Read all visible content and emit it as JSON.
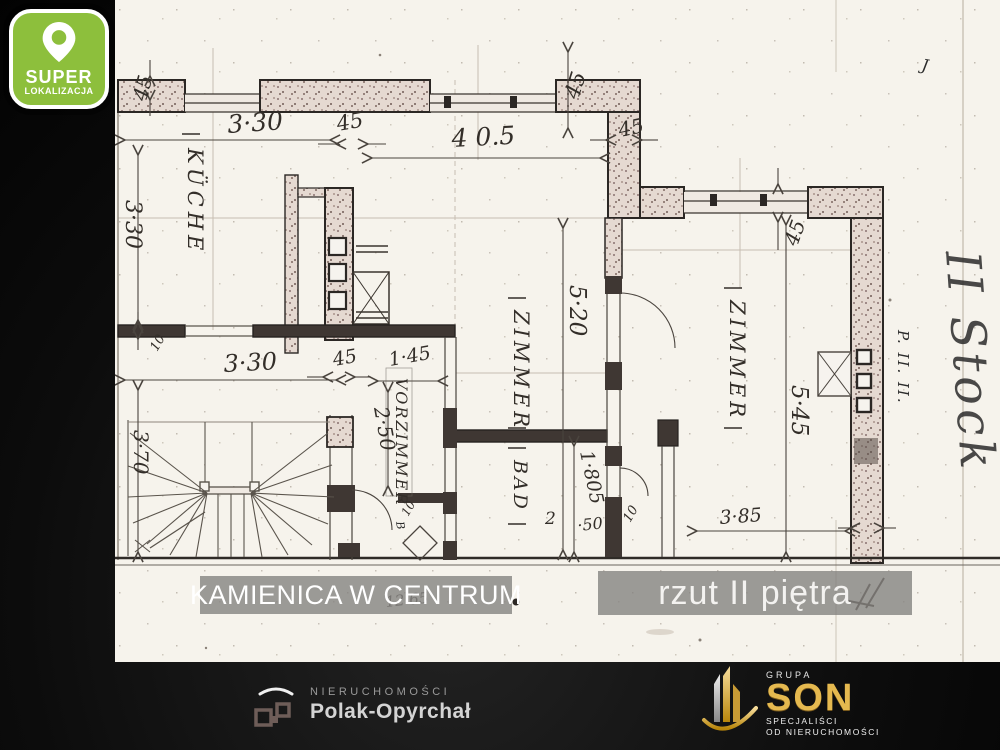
{
  "badge": {
    "title": "SUPER",
    "subtitle": "LOKALIZACJA",
    "color": "#8dbf3c"
  },
  "overlays": {
    "left": "KAMIENICA W CENTRUM",
    "right": "rzut II piętra"
  },
  "plan": {
    "rooms": {
      "kitchen": "KÜCHE",
      "room_center": "ZIMMER",
      "room_right": "ZIMMER",
      "bath": "BAD",
      "hall": "VORZIMMER"
    },
    "dims": {
      "top_width": "3·30",
      "wall_45": "45",
      "top_width2": "4 0.5",
      "left_height": "3·30",
      "left_height2": "3·70",
      "mid_width": "3·30",
      "mid_145": "1·45",
      "hall_depth": "2·50",
      "room_height": "5·20",
      "room2_height": "5·45",
      "bath_1805": "1·805",
      "bath_2": "2",
      "bath_50": "·50",
      "right_width": "3·85",
      "tick_10": "10"
    },
    "annotations": {
      "floor_note": "II Stock",
      "plan_ref": "P. II. II.",
      "corner_mark": "J",
      "scribble": "12 65",
      "letter_b": "B"
    }
  },
  "footer": {
    "agency": {
      "top": "NIERUCHOMOŚCI",
      "name": "Polak-Opyrchał"
    },
    "group": {
      "grupa": "GRUPA",
      "name": "SON",
      "sub1": "SPECJALIŚCI",
      "sub2": "OD NIERUCHOMOŚCI"
    }
  }
}
